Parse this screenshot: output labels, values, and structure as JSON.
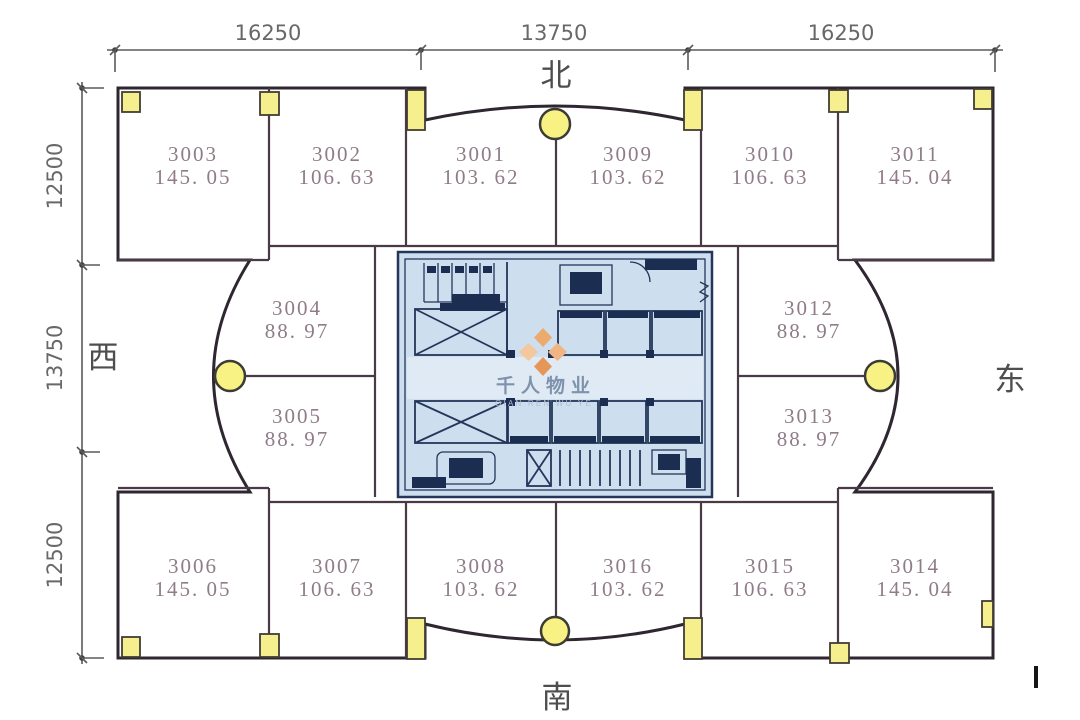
{
  "title": "office-floor-plan",
  "compass": {
    "north": "北",
    "south": "南",
    "west": "西",
    "east": "东"
  },
  "dimensions": {
    "top": [
      {
        "label": "16250"
      },
      {
        "label": "13750"
      },
      {
        "label": "16250"
      }
    ],
    "left": [
      {
        "label": "12500"
      },
      {
        "label": "13750"
      },
      {
        "label": "12500"
      }
    ]
  },
  "rooms": [
    {
      "number": "3003",
      "area": "145. 05"
    },
    {
      "number": "3002",
      "area": "106. 63"
    },
    {
      "number": "3001",
      "area": "103. 62"
    },
    {
      "number": "3009",
      "area": "103. 62"
    },
    {
      "number": "3010",
      "area": "106. 63"
    },
    {
      "number": "3011",
      "area": "145. 04"
    },
    {
      "number": "3004",
      "area": "88. 97"
    },
    {
      "number": "3005",
      "area": "88. 97"
    },
    {
      "number": "3012",
      "area": "88. 97"
    },
    {
      "number": "3013",
      "area": "88. 97"
    },
    {
      "number": "3006",
      "area": "145. 05"
    },
    {
      "number": "3007",
      "area": "106. 63"
    },
    {
      "number": "3008",
      "area": "103. 62"
    },
    {
      "number": "3016",
      "area": "103. 62"
    },
    {
      "number": "3015",
      "area": "106. 63"
    },
    {
      "number": "3014",
      "area": "145. 04"
    }
  ],
  "watermark": {
    "name": "千人物业",
    "subtitle": "QIAN REN WU YE"
  },
  "colors": {
    "room_fill": "#f8dce9",
    "outer_wall": "#2e2630",
    "inner_wall": "#4a3a46",
    "column_yellow": "#f6ef8d",
    "core_fill": "#cddeee",
    "core_line": "#24365a",
    "watermark_orange": "#edaa6d",
    "room_text": "#907c89",
    "dimension_text": "#686868"
  }
}
